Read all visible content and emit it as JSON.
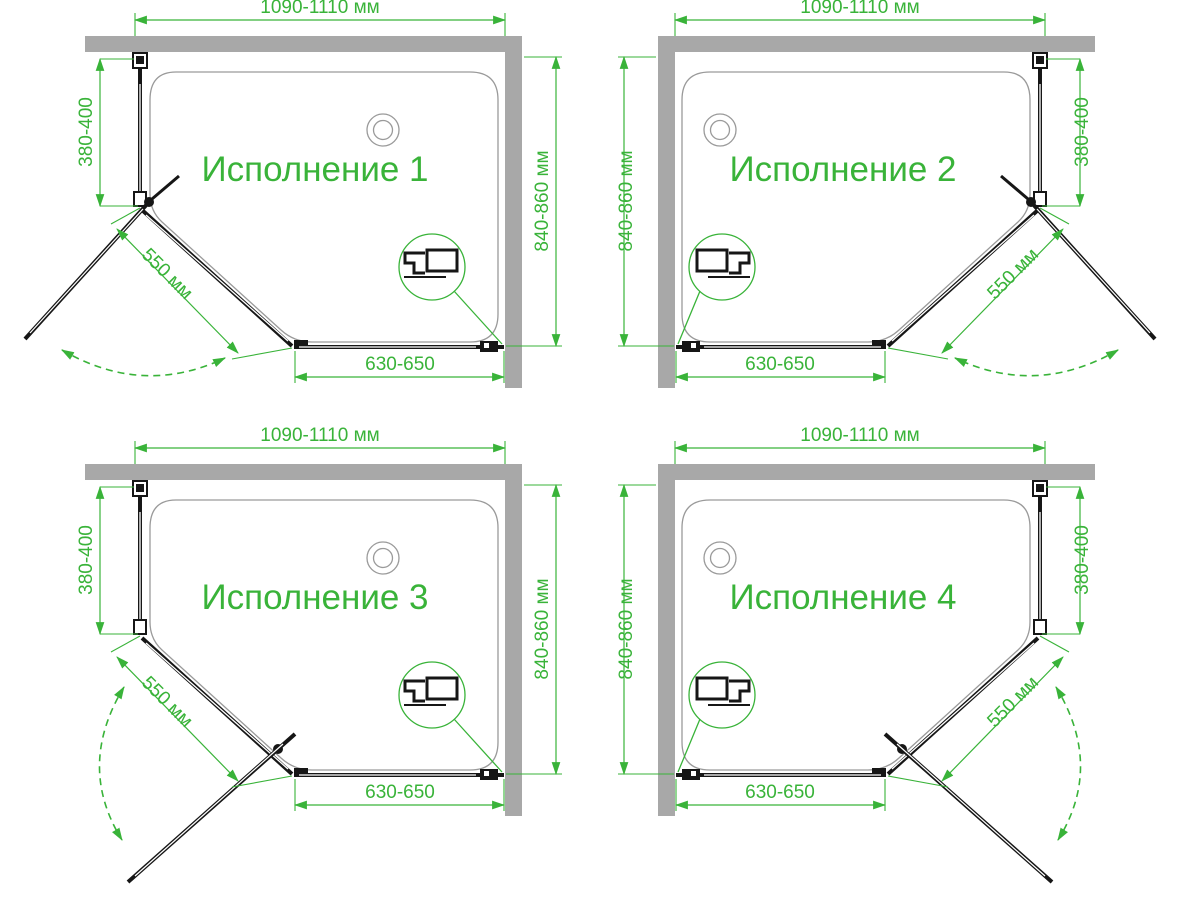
{
  "page": {
    "background": "#ffffff"
  },
  "colors": {
    "accent_green": "#39b339",
    "wall_gray": "#a8a8a8",
    "frame_black": "#161616",
    "tray_gray": "#9a9a9a"
  },
  "diagrams": [
    {
      "id": "variant-1",
      "title": "Исполнение 1",
      "wall_side": "right",
      "door_hinge": "top",
      "dimensions": {
        "width": "1090-1110 мм",
        "height": "840-860 мм",
        "side": "380-400",
        "diagonal": "550 мм",
        "bottom": "630-650"
      }
    },
    {
      "id": "variant-2",
      "title": "Исполнение 2",
      "wall_side": "left",
      "door_hinge": "top",
      "dimensions": {
        "width": "1090-1110 мм",
        "height": "840-860 мм",
        "side": "380-400",
        "diagonal": "550 мм",
        "bottom": "630-650"
      }
    },
    {
      "id": "variant-3",
      "title": "Исполнение 3",
      "wall_side": "right",
      "door_hinge": "bottom",
      "dimensions": {
        "width": "1090-1110 мм",
        "height": "840-860 мм",
        "side": "380-400",
        "diagonal": "550 мм",
        "bottom": "630-650"
      }
    },
    {
      "id": "variant-4",
      "title": "Исполнение 4",
      "wall_side": "left",
      "door_hinge": "bottom",
      "dimensions": {
        "width": "1090-1110 мм",
        "height": "840-860 мм",
        "side": "380-400",
        "diagonal": "550 мм",
        "bottom": "630-650"
      }
    }
  ]
}
